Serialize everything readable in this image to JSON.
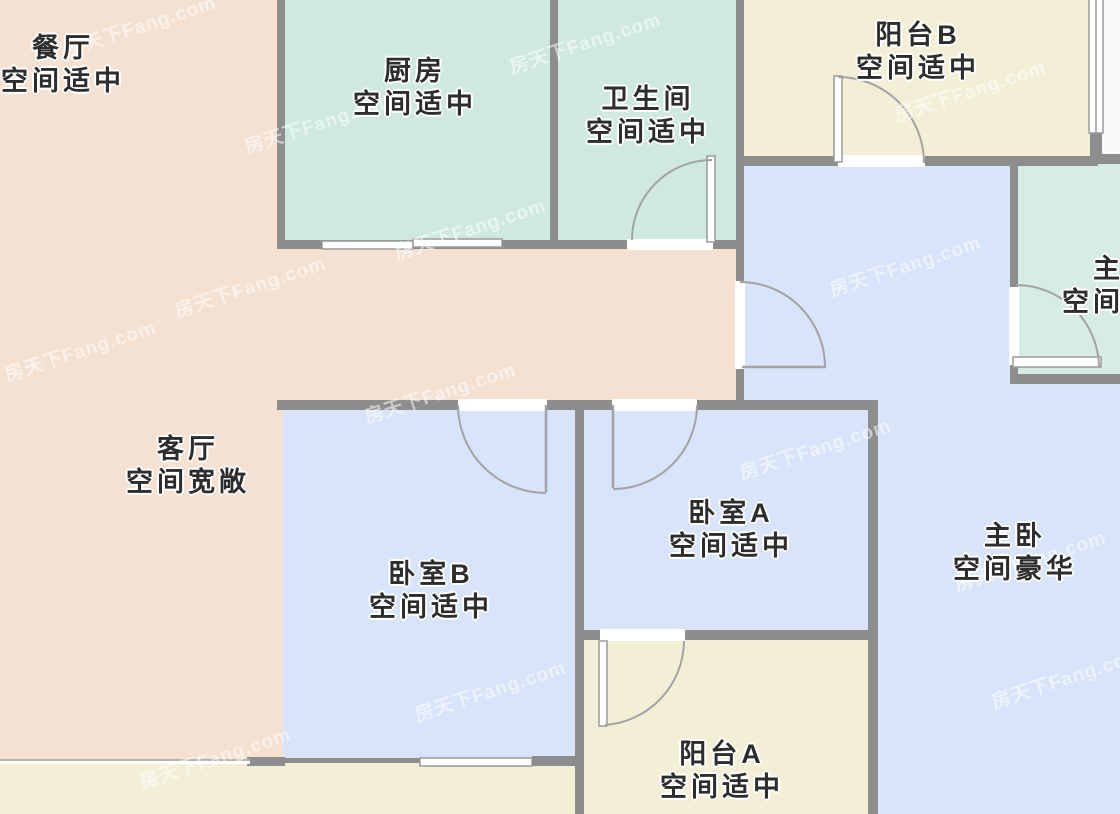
{
  "plan_title": "户型图",
  "watermark": {
    "text": "房天下Fang.com"
  },
  "rooms": {
    "dining": {
      "name": "餐厅",
      "size": "空间适中"
    },
    "kitchen": {
      "name": "厨房",
      "size": "空间适中"
    },
    "bathroom": {
      "name": "卫生间",
      "size": "空间适中"
    },
    "balcony_b": {
      "name": "阳台B",
      "size": "空间适中"
    },
    "living": {
      "name": "客厅",
      "size": "空间宽敞"
    },
    "bedroom_b": {
      "name": "卧室B",
      "size": "空间适中"
    },
    "bedroom_a": {
      "name": "卧室A",
      "size": "空间适中"
    },
    "master_bedroom": {
      "name": "主卧",
      "size": "空间豪华"
    },
    "balcony_a": {
      "name": "阳台A",
      "size": "空间适中"
    },
    "master_bathroom": {
      "name": "主卫",
      "size": "空间适中"
    }
  },
  "colors": {
    "living_dining": "#f5e1d2",
    "kitchen_bath": "#cfe9e0",
    "master_bathroom": "#d7ece4",
    "balcony": "#f3efd7",
    "bedroom": "#d8e4f9",
    "wall": "#8d8d8d",
    "door_line": "#a3a3a3",
    "window_line": "#9a9a9a",
    "outside": "#fafaf8",
    "label_text": "#2d2d2d",
    "watermark_text": "rgba(255,255,255,0.55)"
  }
}
